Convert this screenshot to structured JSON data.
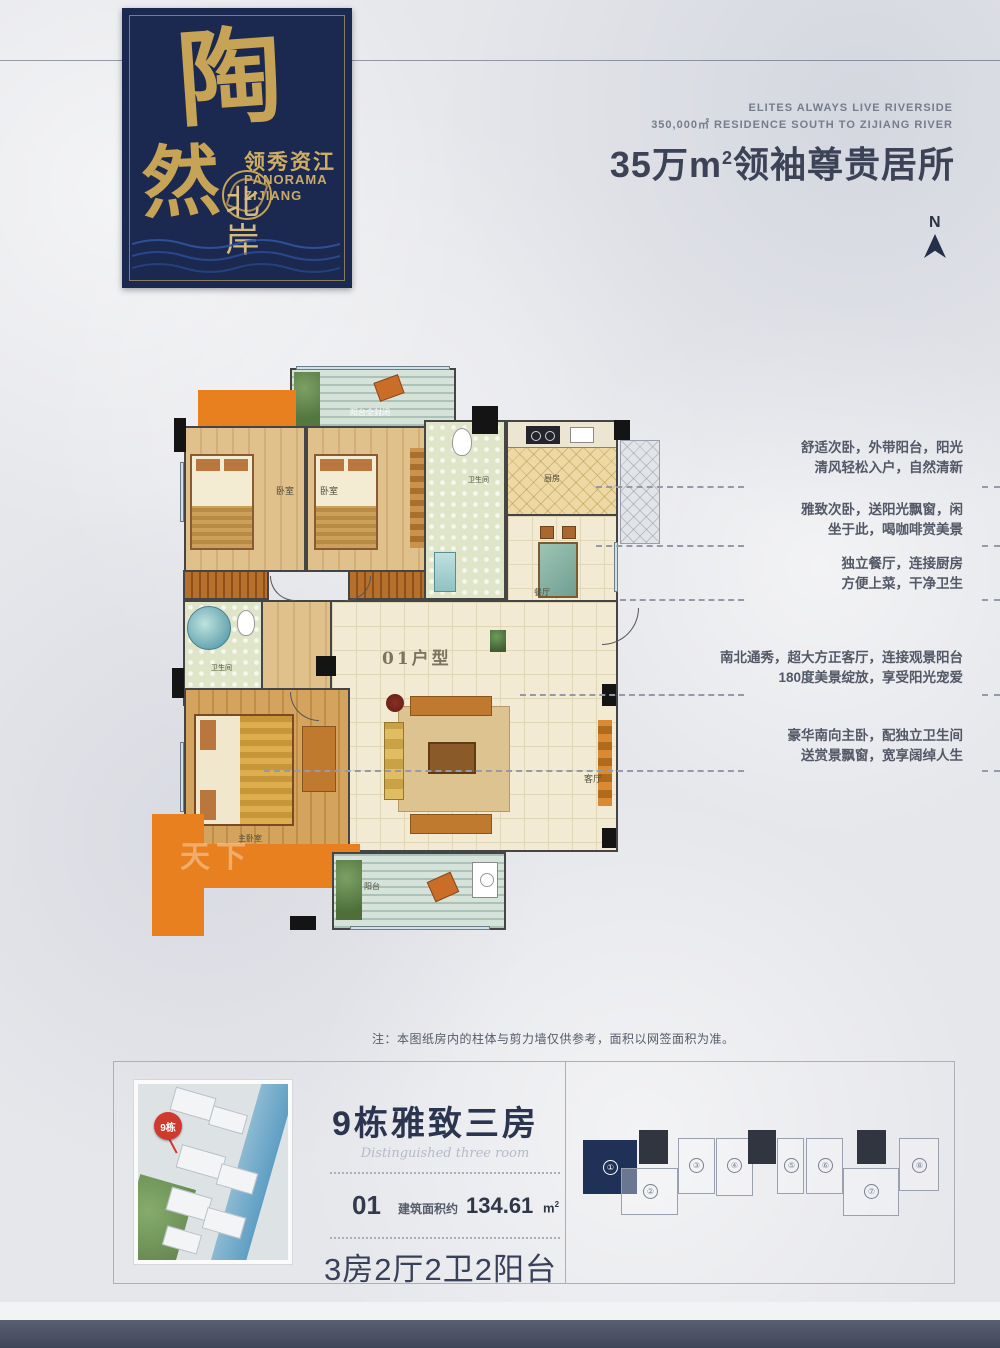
{
  "logo": {
    "char1": "陶",
    "char2": "然",
    "brand_cn": "领秀资江",
    "brand_en_line1": "PANORAMA",
    "brand_en_line2": "ZIJIANG",
    "subtitle_vertical": "北岸"
  },
  "header": {
    "en_line1": "ELITES ALWAYS LIVE RIVERSIDE",
    "en_line2": "350,000㎡ RESIDENCE SOUTH TO ZIJIANG RIVER",
    "headline_text": "35万m",
    "headline_sup": "2",
    "headline_rest": "领袖尊贵居所",
    "compass": "N"
  },
  "floorplan": {
    "unit_label": "01户型",
    "labels": {
      "balcony_top": "阳台全封闭",
      "bedroom_left": "卧室",
      "bedroom_right": "卧室",
      "bathroom": "卫生间",
      "master_bathroom": "卫生间",
      "kitchen": "厨房",
      "dining": "餐厅",
      "living": "客厅",
      "master_bedroom": "主卧室",
      "balcony_bottom": "阳台"
    },
    "watermark": "天下"
  },
  "annotations": [
    {
      "line1": "舒适次卧，外带阳台，阳光",
      "line2": "清风轻松入户，自然清新"
    },
    {
      "line1": "雅致次卧，送阳光飘窗，闲",
      "line2": "坐于此，喝咖啡赏美景"
    },
    {
      "line1": "独立餐厅，连接厨房",
      "line2": "方便上菜，干净卫生"
    },
    {
      "line1": "南北通秀，超大方正客厅，连接观景阳台",
      "line2": "180度美景绽放，享受阳光宠爱"
    },
    {
      "line1": "豪华南向主卧，配独立卫生间",
      "line2": "送赏景飘窗，宽享阔绰人生"
    }
  ],
  "note": "注：本图纸房内的柱体与剪力墙仅供参考，面积以网签面积为准。",
  "bottom": {
    "photo_badge": "9栋",
    "title": "9栋雅致三房",
    "subtitle": "Distinguished three room",
    "unit_no": "01",
    "area_label": "建筑面积约",
    "area_value": "134.61",
    "area_unit": "m",
    "area_sup": "2",
    "layout": "3房2厅2卫2阳台",
    "keyplan": [
      "①",
      "②",
      "③",
      "④",
      "⑤",
      "⑥",
      "⑦",
      "⑧"
    ]
  },
  "colors": {
    "badge_navy": "#1b2950",
    "gold": "#c6a355",
    "accent_orange": "#e8801f",
    "highlight_navy": "#203158",
    "badge_red": "#d03a2e",
    "text_dark": "#3d4356"
  }
}
